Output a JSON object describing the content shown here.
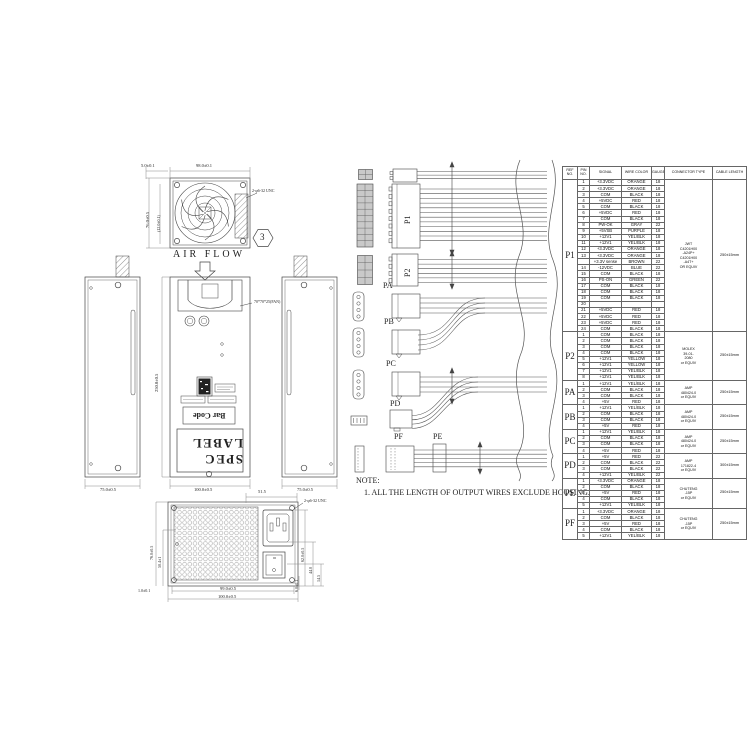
{
  "drawing": {
    "fan_view": {
      "dim_inset": "5.0±0.1",
      "dim_width": "98.0±0.1",
      "dim_height": "76.0±0.5",
      "dim_inner": "(12.0±0.1)",
      "screw_note": "2-φ6-32 UNC",
      "balloon": "3"
    },
    "air_flow": "AIR FLOW",
    "front_views": {
      "dim_left_bottom": "75.0±0.5",
      "dim_center_bottom": "100.0±0.5",
      "dim_right_bottom": "75.0±0.5",
      "dim_depth": "250.0±0.5",
      "fan_size_note": "70*70*25(FAN)",
      "spec_label": "SPEC LABEL",
      "bar_code": "Bar Code"
    },
    "rear_view": {
      "dim_top": "51.5",
      "screw_note": "2-φ6-32 UNC",
      "dim_right_1": "62.0±0.5",
      "dim_right_2": "44.0",
      "dim_right_3": "14.5",
      "dim_right_bottom": "6.0±0.1",
      "dim_left_1": "76.0±0.5",
      "dim_left_2": "50.4±1",
      "dim_bottom_1": "99.0±0.5",
      "dim_bottom_2": "100.0±0.5",
      "dim_bottom_left": "1.0±0.1"
    },
    "note_title": "NOTE:",
    "note_line": "1. ALL THE LENGTH OF OUTPUT WIRES EXCLUDE HOUSING."
  },
  "harness": {
    "p1": "P1",
    "p2": "P2",
    "pa": "PA",
    "pb": "PB",
    "pc": "PC",
    "pd": "PD",
    "pe": "PE",
    "pf": "PF"
  },
  "table": {
    "headers": [
      "REF NO.",
      "PIN NO.",
      "SIGNAL",
      "WIRE COLOR",
      "GAUGE",
      "CONNECTOR TYPE",
      "CABLE LENGTH"
    ],
    "groups": [
      {
        "ref": "P1",
        "connector": "JWT\nC4201H00\n-A24P+\nC4201H00\n-A4T+\nOR EQUIV",
        "length": "250±15mm",
        "rows": [
          [
            "1",
            "+3.3VDC",
            "ORANGE",
            "18"
          ],
          [
            "2",
            "+3.3VDC",
            "ORANGE",
            "18"
          ],
          [
            "3",
            "COM",
            "BLACK",
            "18"
          ],
          [
            "4",
            "+5VDC",
            "RED",
            "18"
          ],
          [
            "5",
            "COM",
            "BLACK",
            "18"
          ],
          [
            "6",
            "+5VDC",
            "RED",
            "18"
          ],
          [
            "7",
            "COM",
            "BLACK",
            "18"
          ],
          [
            "8",
            "PW-OK",
            "GRAY",
            "22"
          ],
          [
            "9",
            "+5VSB",
            "PURPLE",
            "18"
          ],
          [
            "10",
            "+12V1",
            "YEL/BLK",
            "18"
          ],
          [
            "11",
            "+12V1",
            "YEL/BLK",
            "18"
          ],
          [
            "12",
            "+3.3VDC",
            "ORANGE",
            "18"
          ],
          [
            "13",
            "+3.3VDC",
            "ORANGE",
            "18"
          ],
          [
            "",
            "+3.3V sense",
            "BROWN",
            "22"
          ],
          [
            "14",
            "-12VDC",
            "BLUE",
            "22"
          ],
          [
            "15",
            "COM",
            "BLACK",
            "18"
          ],
          [
            "16",
            "PS-ON",
            "GREEN",
            "22"
          ],
          [
            "17",
            "COM",
            "BLACK",
            "18"
          ],
          [
            "18",
            "COM",
            "BLACK",
            "18"
          ],
          [
            "19",
            "COM",
            "BLACK",
            "18"
          ],
          [
            "20",
            "",
            "",
            ""
          ],
          [
            "21",
            "+5VDC",
            "RED",
            "18"
          ],
          [
            "22",
            "+5VDC",
            "RED",
            "18"
          ],
          [
            "23",
            "+5VDC",
            "RED",
            "18"
          ],
          [
            "24",
            "COM",
            "BLACK",
            "18"
          ]
        ]
      },
      {
        "ref": "P2",
        "connector": "MOLEX\n39-01-\n2080\nor EQUIV",
        "length": "250±15mm",
        "rows": [
          [
            "1",
            "COM",
            "BLACK",
            "18"
          ],
          [
            "2",
            "COM",
            "BLACK",
            "18"
          ],
          [
            "3",
            "COM",
            "BLACK",
            "18"
          ],
          [
            "4",
            "COM",
            "BLACK",
            "18"
          ],
          [
            "5",
            "+12V1",
            "YELLOW",
            "18"
          ],
          [
            "6",
            "+12V1",
            "YELLOW",
            "18"
          ],
          [
            "7",
            "+12V1",
            "YEL/BLK",
            "18"
          ],
          [
            "8",
            "+12V1",
            "YEL/BLK",
            "18"
          ]
        ]
      },
      {
        "ref": "PA",
        "connector": "AMP\n480424-0\nor EQUIV",
        "length": "250±15mm",
        "rows": [
          [
            "1",
            "+12V1",
            "YEL/BLK",
            "18"
          ],
          [
            "2",
            "COM",
            "BLACK",
            "18"
          ],
          [
            "3",
            "COM",
            "BLACK",
            "18"
          ],
          [
            "4",
            "+5V",
            "RED",
            "18"
          ]
        ]
      },
      {
        "ref": "PB",
        "connector": "AMP\n480424-0\nor EQUIV",
        "length": "250±15mm",
        "rows": [
          [
            "1",
            "+12V1",
            "YEL/BLK",
            "18"
          ],
          [
            "2",
            "COM",
            "BLACK",
            "18"
          ],
          [
            "3",
            "COM",
            "BLACK",
            "18"
          ],
          [
            "4",
            "+5V",
            "RED",
            "18"
          ]
        ]
      },
      {
        "ref": "PC",
        "connector": "AMP\n480424-0\nor EQUIV",
        "length": "250±15mm",
        "rows": [
          [
            "1",
            "+12V1",
            "YEL/BLK",
            "18"
          ],
          [
            "2",
            "COM",
            "BLACK",
            "18"
          ],
          [
            "3",
            "COM",
            "BLACK",
            "18"
          ],
          [
            "4",
            "+5V",
            "RED",
            "18"
          ]
        ]
      },
      {
        "ref": "PD",
        "connector": "AMP\n171822-4\nor EQUIV",
        "length": "300±15mm",
        "rows": [
          [
            "1",
            "+5V",
            "RED",
            "22"
          ],
          [
            "2",
            "COM",
            "BLACK",
            "22"
          ],
          [
            "3",
            "COM",
            "BLACK",
            "22"
          ],
          [
            "4",
            "+12V1",
            "YEL/BLK",
            "22"
          ]
        ]
      },
      {
        "ref": "PE",
        "connector": "CHUTENG\n-15P\nor EQUIV",
        "length": "250±15mm",
        "rows": [
          [
            "1",
            "+3.3VDC",
            "ORANGE",
            "18"
          ],
          [
            "2",
            "COM",
            "BLACK",
            "18"
          ],
          [
            "3",
            "+5V",
            "RED",
            "18"
          ],
          [
            "4",
            "COM",
            "BLACK",
            "18"
          ],
          [
            "5",
            "+12V1",
            "YEL/BLK",
            "18"
          ]
        ]
      },
      {
        "ref": "PF",
        "connector": "CHUTENG\n-15P\nor EQUIV",
        "length": "250±15mm",
        "rows": [
          [
            "1",
            "+3.3VDC",
            "ORANGE",
            "18"
          ],
          [
            "2",
            "COM",
            "BLACK",
            "18"
          ],
          [
            "3",
            "+5V",
            "RED",
            "18"
          ],
          [
            "4",
            "COM",
            "BLACK",
            "18"
          ],
          [
            "5",
            "+12V1",
            "YEL/BLK",
            "18"
          ]
        ]
      }
    ]
  }
}
